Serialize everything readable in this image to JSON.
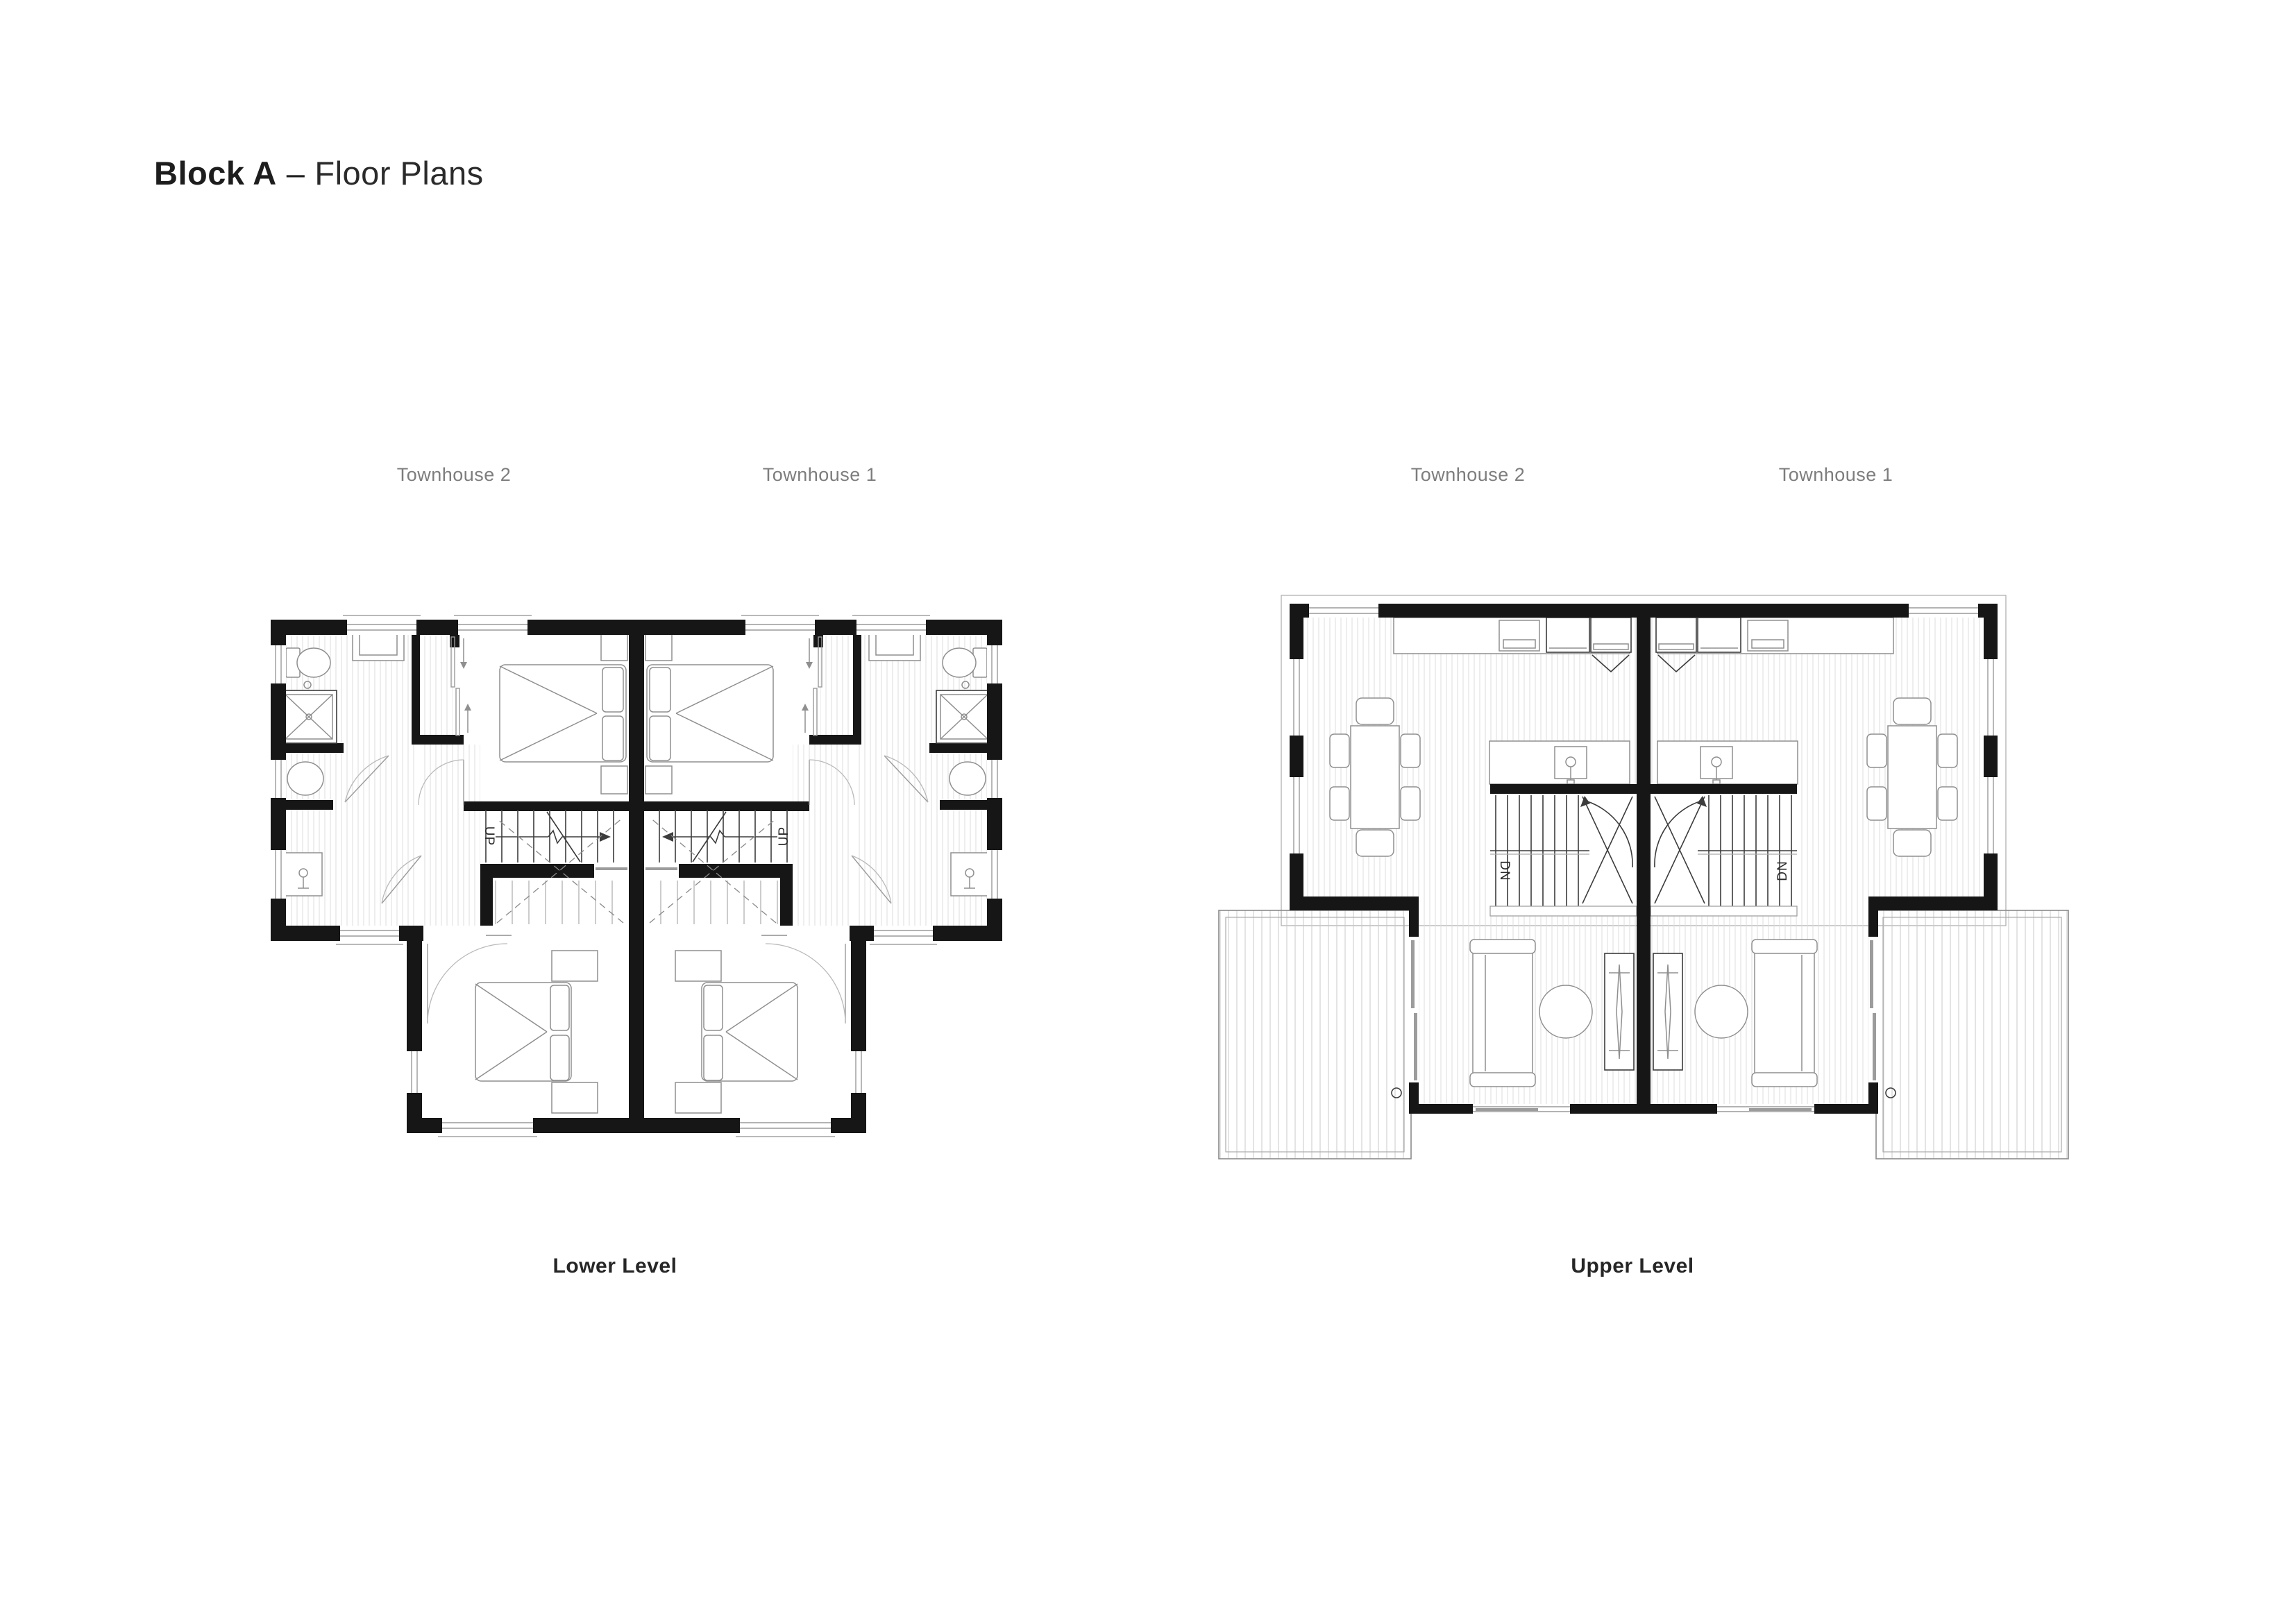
{
  "title": {
    "bold": "Block A",
    "dash": "–",
    "light": "Floor Plans"
  },
  "plans": {
    "lower": {
      "caption": "Lower Level",
      "unit_left": "Townhouse 2",
      "unit_right": "Townhouse 1",
      "stair_label_left": "UP",
      "stair_label_right": "UP"
    },
    "upper": {
      "caption": "Upper Level",
      "unit_left": "Townhouse 2",
      "unit_right": "Townhouse 1",
      "stair_label_left": "DN",
      "stair_label_right": "DN"
    }
  },
  "colors": {
    "wall": "#161616",
    "furniture_line": "#8f8f8f",
    "hatch": "#dcdcdc",
    "deck_hatch": "#c9c9c9",
    "label_gray": "#7d7d7d",
    "text_dark": "#262626",
    "background": "#ffffff"
  }
}
